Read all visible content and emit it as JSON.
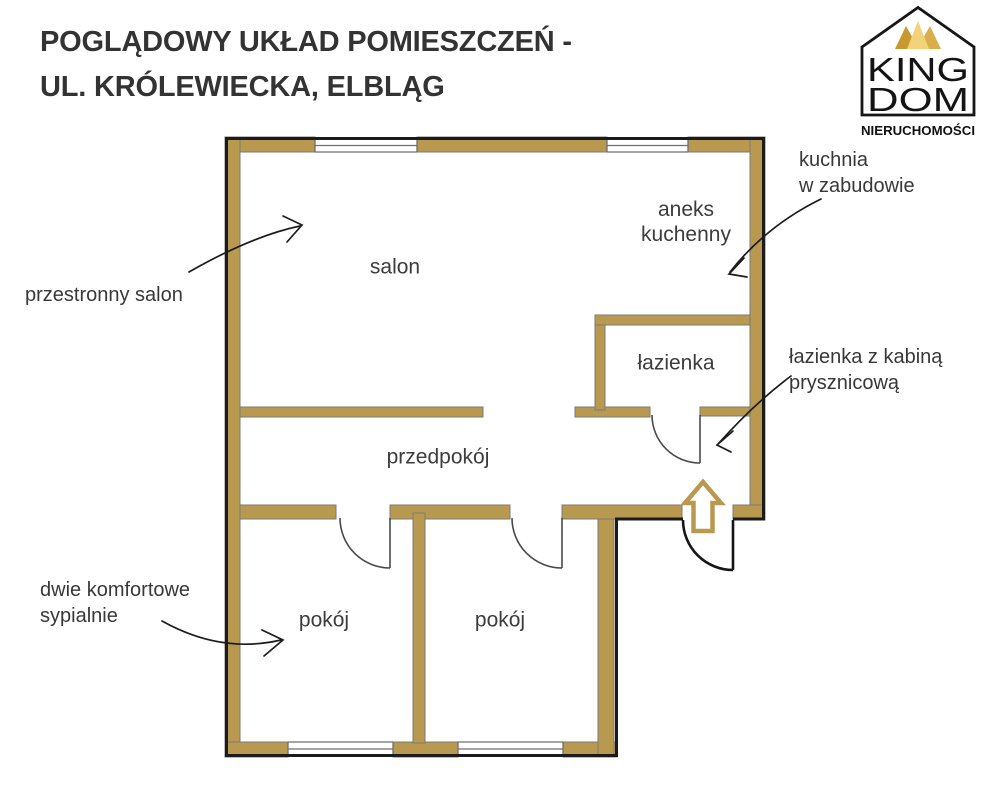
{
  "header": {
    "title_line1": "POGLĄDOWY UKŁAD POMIESZCZEŃ -",
    "title_line2": "UL. KRÓLEWIECKA, ELBLĄG"
  },
  "logo": {
    "name_top": "KING",
    "name_bottom": "DOM",
    "subtitle": "NIERUCHOMOŚCI"
  },
  "plan": {
    "room_labels": {
      "salon": "salon",
      "aneks_line1": "aneks",
      "aneks_line2": "kuchenny",
      "lazienka": "łazienka",
      "przedpokoj": "przedpokój",
      "pokoj1": "pokój",
      "pokoj2": "pokój"
    },
    "annotations": {
      "salon": "przestronny salon",
      "kuchnia_line1": "kuchnia",
      "kuchnia_line2": "w zabudowie",
      "lazienka_line1": "łazienka z kabiną",
      "lazienka_line2": "prysznicową",
      "sypialnie_line1": "dwie komfortowe",
      "sypialnie_line2": "sypialnie"
    }
  },
  "colors": {
    "wall": "#B9994F",
    "wall_outline": "#7A7A7A",
    "perimeter": "#1B1B1B",
    "label_text": "#3C3C3C",
    "title_text": "#333333",
    "gold_dark": "#C9992F",
    "gold_mid": "#D9AE4B",
    "gold_light": "#F2D379"
  }
}
